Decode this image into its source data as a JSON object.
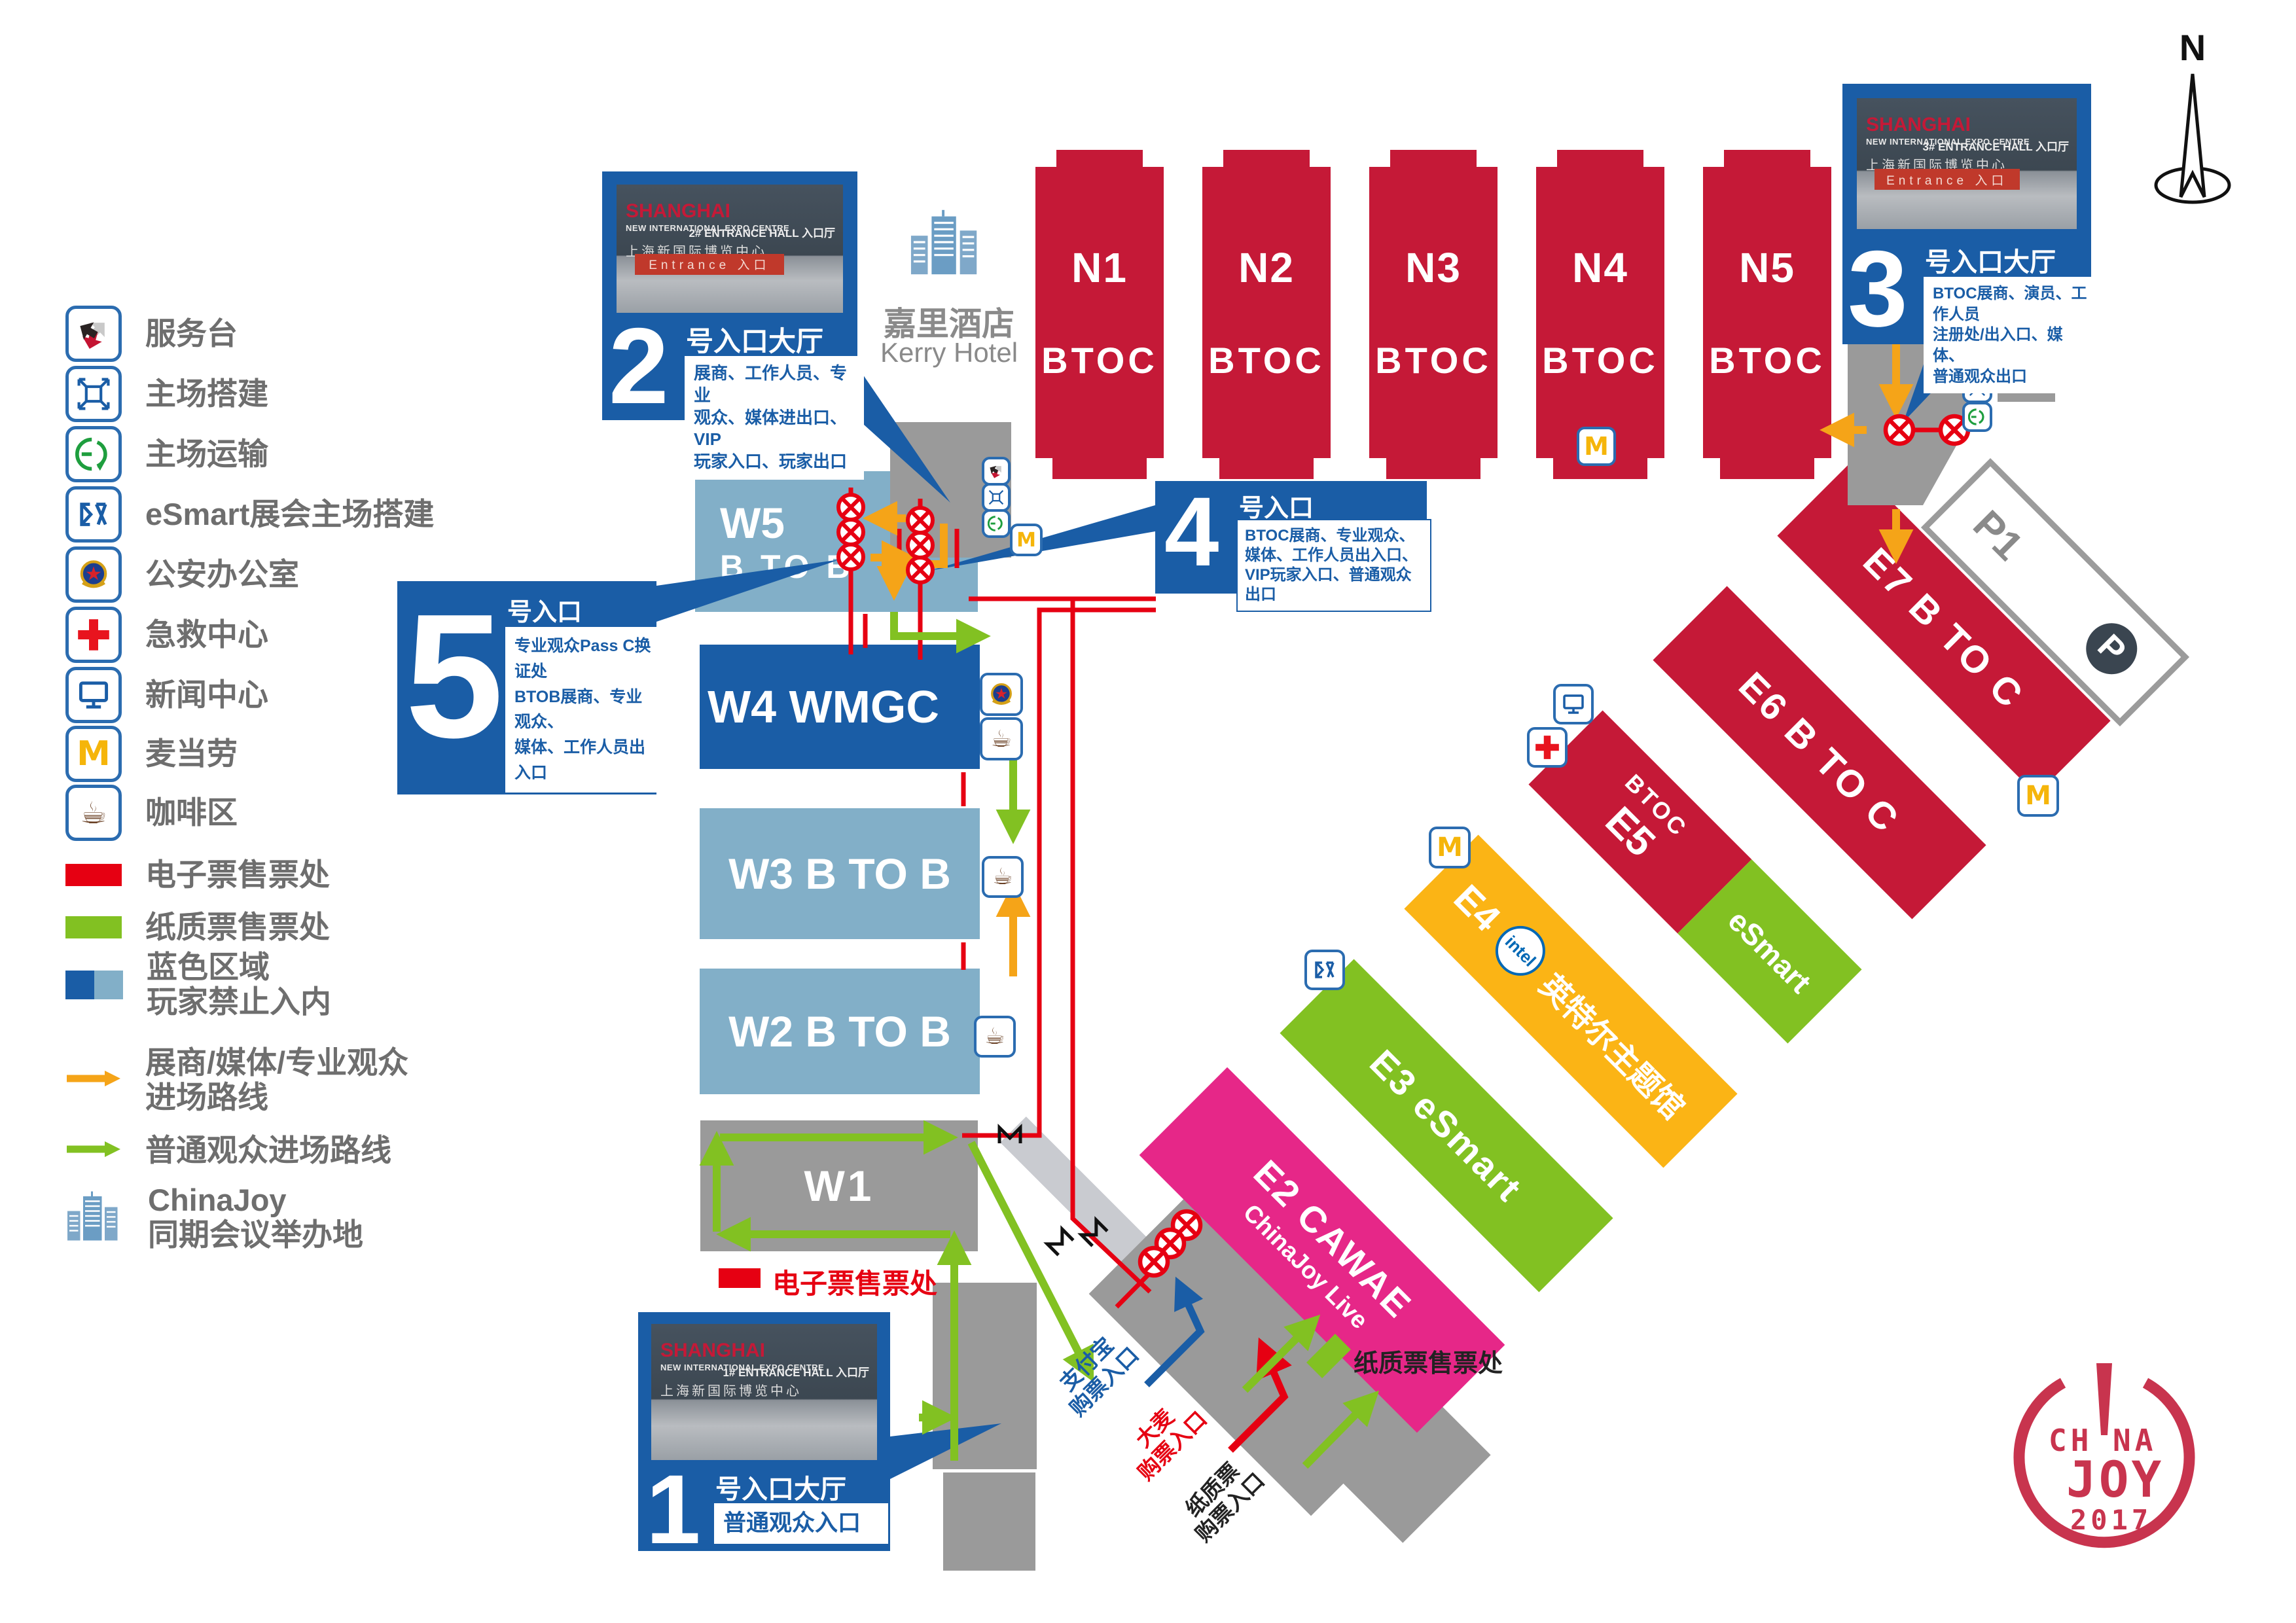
{
  "colors": {
    "accent_blue": "#1A5DA6",
    "crimson": "#C51937",
    "light_blue": "#82AFC8",
    "dark_blue": "#1A5DA6",
    "gray": "#9A9A9A",
    "walkway": "#C9CBD0",
    "green": "#82C122",
    "yellow": "#FBB415",
    "magenta": "#E62788",
    "orange": "#F5A418",
    "route_red": "#E60012",
    "intel_blue": "#0068B5",
    "p_pink": "#F06E8E",
    "p_dark": "#3A4550",
    "text_gray": "#6e6e6e"
  },
  "legend": {
    "items": [
      {
        "icon": "service-desk",
        "label": "服务台"
      },
      {
        "icon": "venue-construction",
        "label": "主场搭建"
      },
      {
        "icon": "venue-transport",
        "label": "主场运输"
      },
      {
        "icon": "esmart-construction",
        "label": "eSmart展会主场搭建"
      },
      {
        "icon": "police-office",
        "label": "公安办公室"
      },
      {
        "icon": "first-aid",
        "label": "急救中心"
      },
      {
        "icon": "news-center",
        "label": "新闻中心"
      },
      {
        "icon": "mcdonalds",
        "label": "麦当劳"
      },
      {
        "icon": "coffee-area",
        "label": "咖啡区"
      },
      {
        "icon": "eticket-swatch",
        "label": "电子票售票处"
      },
      {
        "icon": "paper-ticket-swatch",
        "label": "纸质票售票处"
      },
      {
        "icon": "blue-zones",
        "label": "蓝色区域",
        "label2": "玩家禁止入内"
      },
      {
        "icon": "orange-route",
        "label": "展商/媒体/专业观众",
        "label2": "进场路线"
      },
      {
        "icon": "green-route",
        "label": "普通观众进场路线"
      },
      {
        "icon": "chinajoy-building",
        "label": "ChinaJoy",
        "label2": "同期会议举办地"
      }
    ]
  },
  "compass": {
    "label": "N"
  },
  "kerry": {
    "zh": "嘉里酒店",
    "en": "Kerry Hotel"
  },
  "halls": {
    "north": [
      {
        "name": "N1",
        "type": "BTOC"
      },
      {
        "name": "N2",
        "type": "BTOC"
      },
      {
        "name": "N3",
        "type": "BTOC"
      },
      {
        "name": "N4",
        "type": "BTOC"
      },
      {
        "name": "N5",
        "type": "BTOC"
      }
    ],
    "west": [
      {
        "label1": "W5",
        "label2": "B TO B"
      },
      {
        "label1": "W4 WMGC"
      },
      {
        "label1": "W3 B TO B"
      },
      {
        "label1": "W2 B TO B"
      },
      {
        "label1": "W1"
      }
    ],
    "east": [
      {
        "title": "E2 CAWAE",
        "subtitle": "ChinaJoy Live"
      },
      {
        "title": "E3 eSmart"
      },
      {
        "prefix": "E4",
        "intel": "intel",
        "suffix": "英特尔主题馆"
      },
      {
        "red_small": "BTOC",
        "red_big": "E5",
        "green_label": "eSmart"
      },
      {
        "title": "E6 B TO C"
      },
      {
        "title": "E7 B TO C"
      }
    ],
    "parking": {
      "name": "P1",
      "badge": "P"
    }
  },
  "entrances": [
    {
      "num": "1",
      "title": "号入口大厅",
      "line1": "普通观众入口",
      "photo_hall": "1# ENTRANCE HALL 入口厅"
    },
    {
      "num": "2",
      "title": "号入口大厅",
      "line1": "展商、工作人员、专业",
      "line2": "观众、媒体进出口、VIP",
      "line3": "玩家入口、玩家出口",
      "photo_hall": "2# ENTRANCE HALL 入口厅"
    },
    {
      "num": "3",
      "title": "号入口大厅",
      "line1": "BTOC展商、演员、工作人员",
      "line2": "注册处/出入口、媒体、",
      "line3": "普通观众出口",
      "photo_hall": "3# ENTRANCE HALL 入口厅"
    },
    {
      "num": "4",
      "title": "号入口",
      "line1": "BTOC展商、专业观众、",
      "line2": "媒体、工作人员出入口、",
      "line3": "VIP玩家入口、普通观众出口"
    },
    {
      "num": "5",
      "title": "号入口",
      "line1": "专业观众Pass C换证处",
      "line2": "BTOB展商、专业观众、",
      "line3": "媒体、工作人员出入口"
    }
  ],
  "photo": {
    "brand": "SHANGHAI",
    "brand2": "NEW INTERNATIONAL EXPO CENTRE",
    "zh": "上海新国际博览中心",
    "banner": "Entrance 入口"
  },
  "tickets": {
    "eticket": "电子票售票处",
    "paper_office": "纸质票售票处",
    "alipay": "支付宝",
    "damai": "大麦",
    "paper": "纸质票",
    "buy": "购票入口"
  },
  "icons": {
    "mcdonalds": "M",
    "coffee": "☕",
    "parking": "P"
  },
  "logo": {
    "top": "CH!NA",
    "mid": "JOY",
    "year": "2017"
  }
}
